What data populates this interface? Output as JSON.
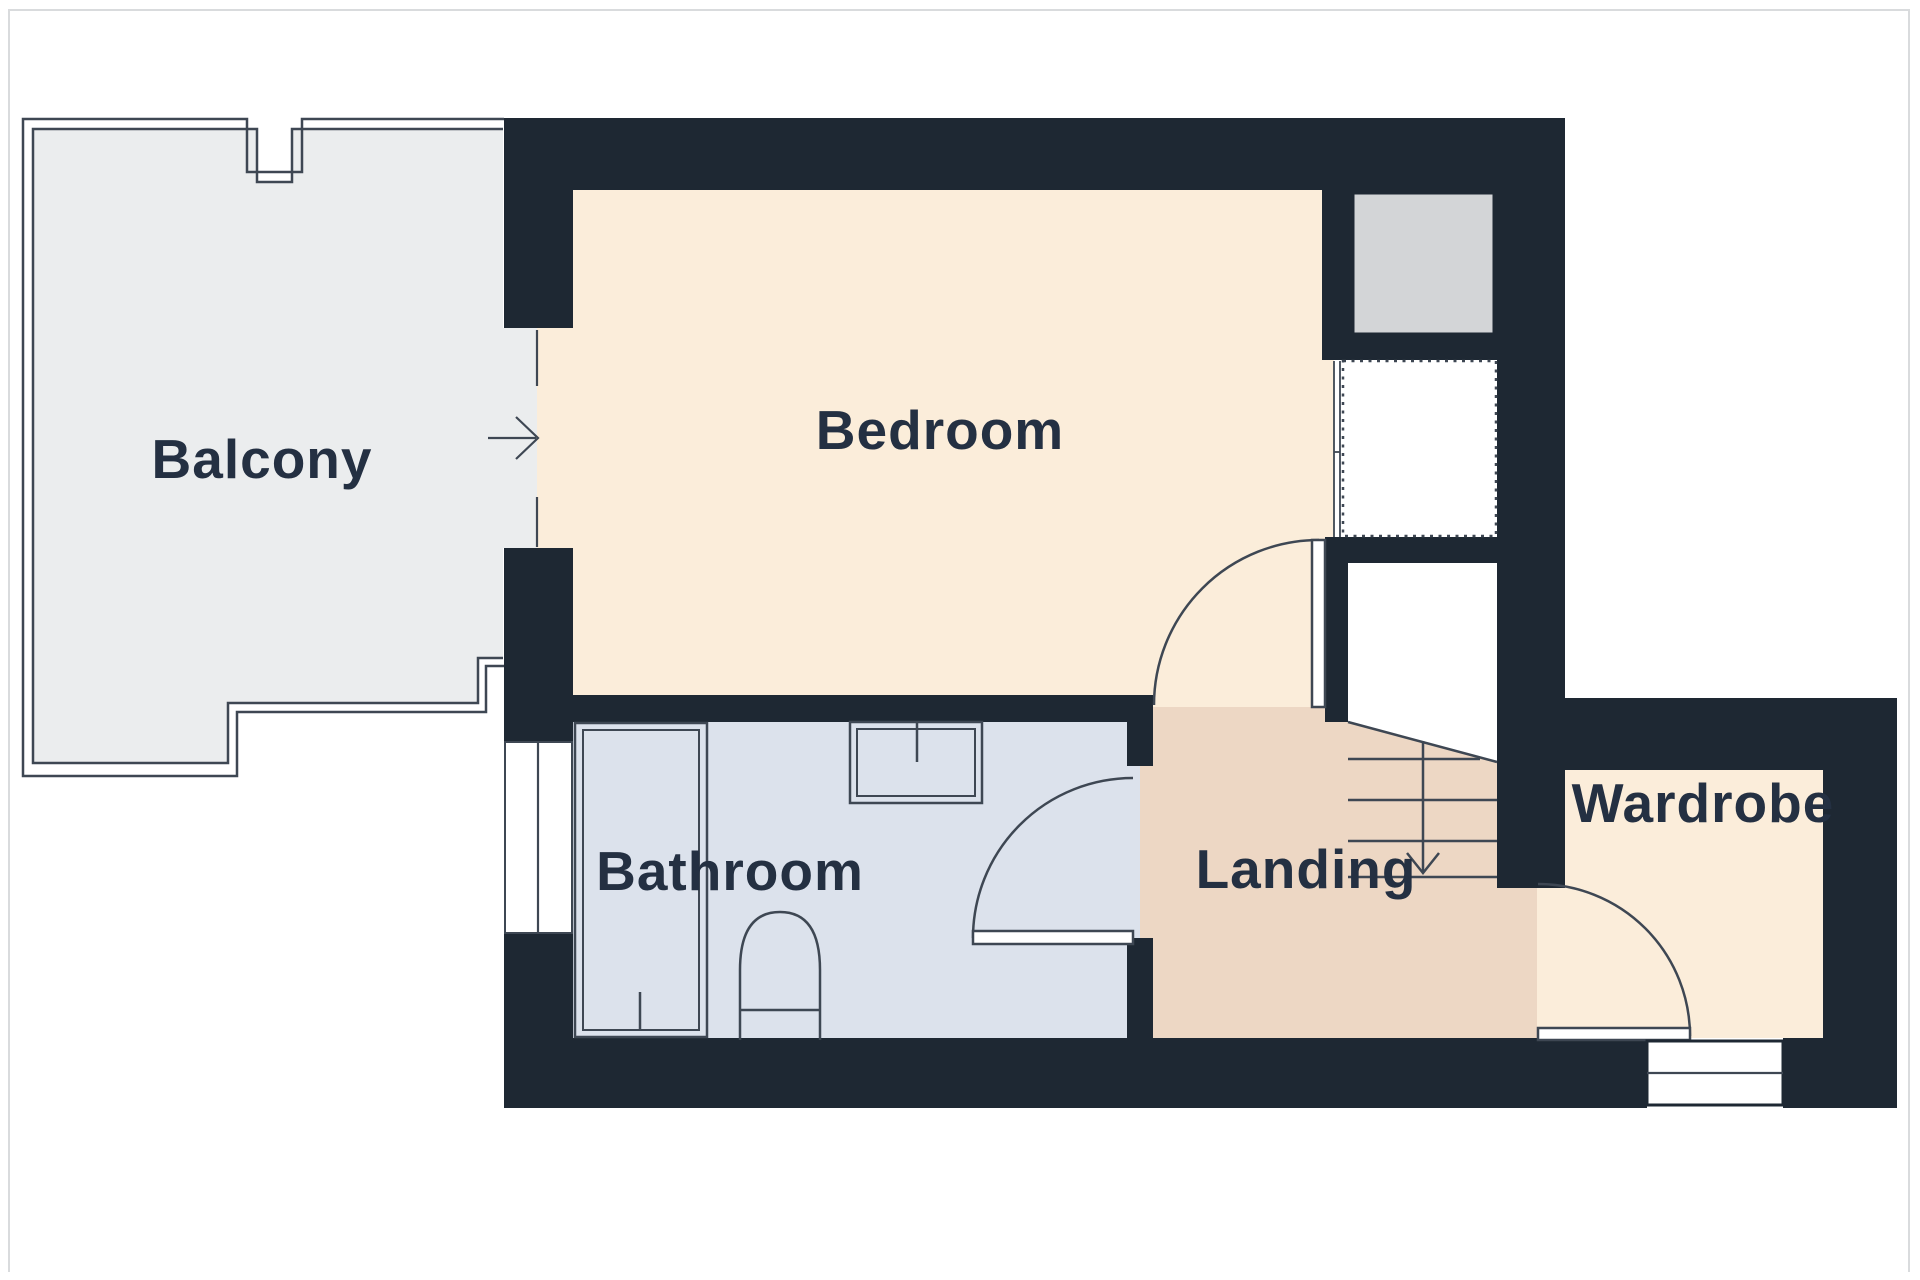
{
  "plan": {
    "type": "floor-plan",
    "rooms": {
      "balcony": {
        "label": "Balcony"
      },
      "bedroom": {
        "label": "Bedroom"
      },
      "bathroom": {
        "label": "Bathroom"
      },
      "landing": {
        "label": "Landing"
      },
      "wardrobe": {
        "label": "Wardrobe"
      }
    },
    "features": {
      "stairs_direction": "down",
      "fixtures": [
        "shower",
        "sink",
        "toilet"
      ],
      "doors": [
        "balcony-to-bedroom",
        "bedroom-to-landing",
        "bathroom-to-landing",
        "landing-to-wardrobe"
      ],
      "windows": [
        "bathroom-left-wall",
        "wardrobe-bottom-wall"
      ]
    },
    "colors": {
      "wall": "#1e2833",
      "bedroom": "#fbedda",
      "wardrobe": "#fbedda",
      "landing": "#edd7c4",
      "bathroom": "#dce2ec",
      "balcony": "#ebedee",
      "graybox": "#d3d5d7",
      "line": "#3e4753",
      "label": "#243042",
      "pageBorder": "#d9dbdd",
      "white": "#ffffff"
    }
  }
}
